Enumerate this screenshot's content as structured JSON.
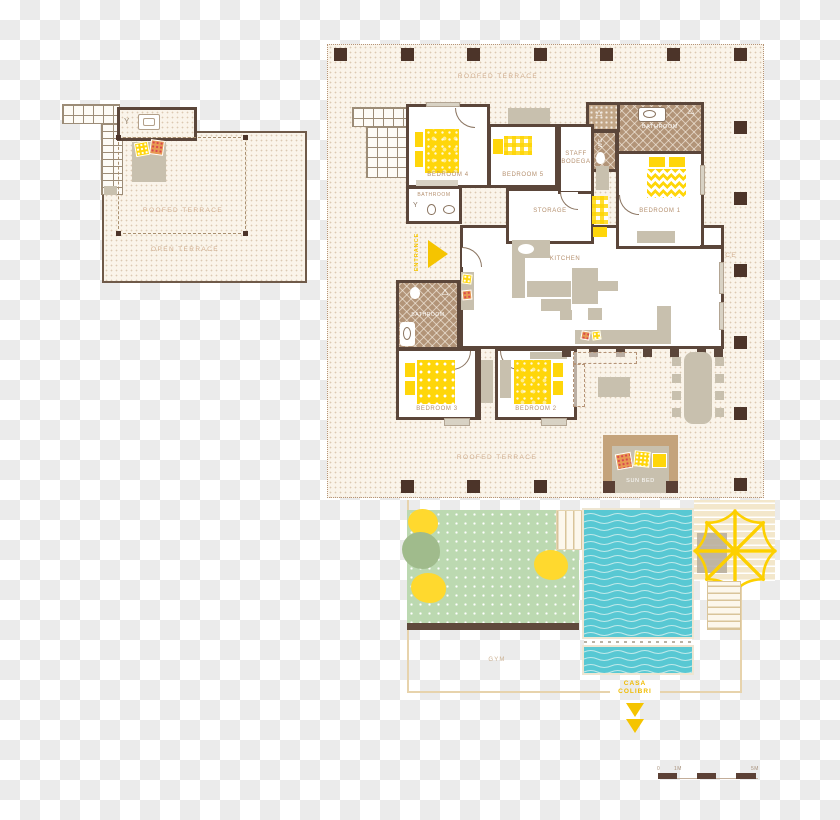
{
  "upper_plan": {
    "roofed_terrace_label": "ROOFED TERRACE",
    "open_terrace_label": "OPEN TERRACE"
  },
  "main_plan": {
    "terrace_label_top": "ROOFED TERRACE",
    "terrace_label_right": "ROOFED TERRACE",
    "terrace_label_bottom": "ROOFED TERRACE",
    "entrance_label": "ENTRANCE",
    "rooms": {
      "bedroom1": "BEDROOM 1",
      "bedroom2": "BEDROOM 2",
      "bedroom3": "BEDROOM 3",
      "bedroom4": "BEDROOM 4",
      "bedroom5": "BEDROOM 5",
      "staff_line1": "STAFF",
      "staff_line2": "BODEGA",
      "wc": "WC",
      "bathroom_top": "BATHROOM",
      "bathroom_mid": "BATHROOM",
      "bathroom_lower": "BATHROOM",
      "storage": "STORAGE",
      "kitchen": "KITCHEN",
      "sun_bed": "SUN BED"
    }
  },
  "grounds": {
    "gym_label": "GYM",
    "villa_name_line1": "CASA",
    "villa_name_line2": "COLIBRI"
  },
  "scale_bar": {
    "tick0": "0",
    "tick1m": "1M",
    "tick5m": "5M"
  },
  "colors": {
    "wall": "#5b463a",
    "column": "#4c3429",
    "plan_background": "#faf4ea",
    "accent_yellow": "#ffd60a",
    "entrance_yellow": "#f5c400",
    "pool_blue": "#58c8d3",
    "garden_green": "#bcd9b1",
    "bathroom_tile": "#b29478",
    "furniture_gray": "#c8c0ae",
    "label_tan": "#b5906f",
    "terrace_label": "#d2b091",
    "deck_beige": "#f3e7cb"
  }
}
